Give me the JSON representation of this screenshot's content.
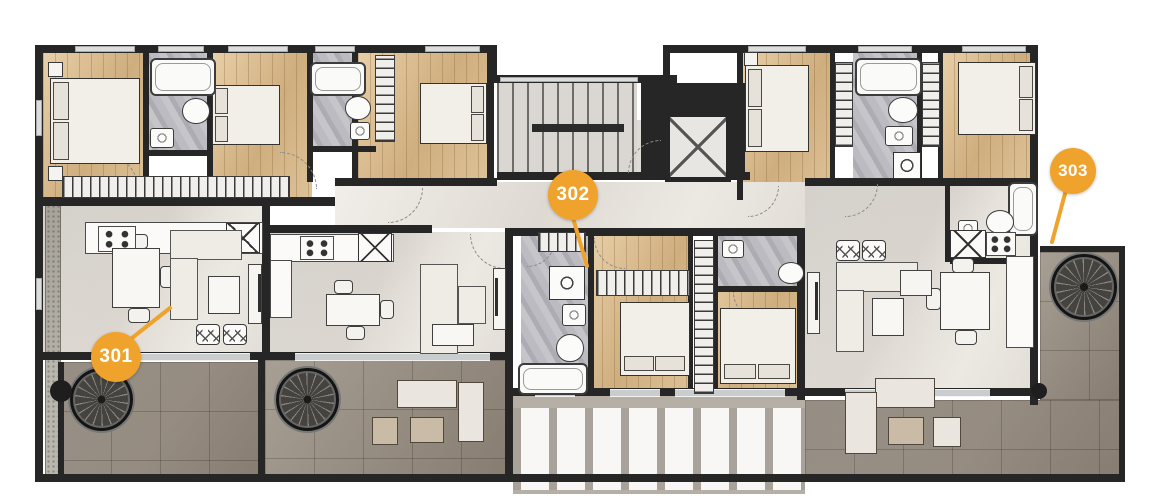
{
  "plan": {
    "name": "Residential floor plan — level 3",
    "floor_label_text": ""
  },
  "units": [
    {
      "id": "unit-301",
      "label": "301"
    },
    {
      "id": "unit-302",
      "label": "302"
    },
    {
      "id": "unit-303",
      "label": "303"
    }
  ],
  "colors": {
    "accent": "#F0A32C",
    "wall": "#262626",
    "wood_floor": "#D5B88C",
    "interior_tile": "#E9E6E1",
    "bathroom_marble": "#B9B8BC",
    "terrace_tile": "#998F83",
    "background": "#FFFFFF"
  },
  "icons": [
    "spiral-staircase-icon",
    "staircase-icon",
    "elevator-icon",
    "bathtub-icon",
    "toilet-icon",
    "sink-icon",
    "washing-machine-icon",
    "stove-icon",
    "pantry-icon",
    "double-bed-icon",
    "sofa-icon",
    "dining-table-icon",
    "wardrobe-icon",
    "pergola-icon",
    "planter-icon",
    "tv-console-icon",
    "door-swing-icon",
    "window-icon"
  ]
}
